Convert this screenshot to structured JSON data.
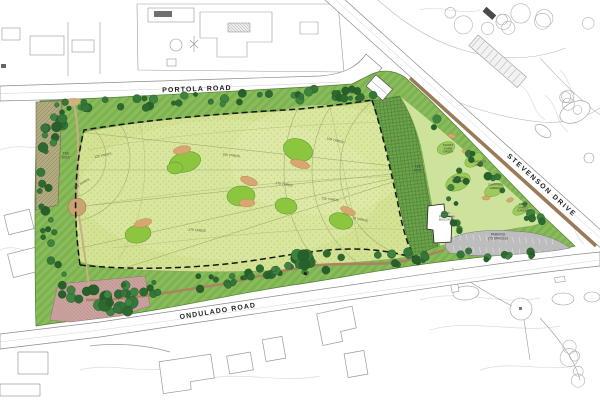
{
  "plan": {
    "roads": {
      "portola": "PORTOLA ROAD",
      "stevenson": "STEVENSON DRIVE",
      "ondulado": "ONDULADO ROAD"
    },
    "site": {
      "tee_box_west": "TEE BOX",
      "tee_box_east": "TEE BOX",
      "short_game_green": "SHORT GAME GREEN",
      "practice_tee": "PRACTICE TEE",
      "putting_green": "PUTTING GREEN",
      "chipping_green": "CHIPPING GREEN",
      "lawn_games_garden": "LAWN GAMES GARDEN",
      "building": "GOLF PROGRAM BUILDING",
      "parking_title": "PARKING",
      "parking_detail": "(75 SPACES)"
    },
    "yardage_markers": [
      {
        "text": "125 YARDS"
      },
      {
        "text": "100 YARDS"
      },
      {
        "text": "150 YARDS"
      },
      {
        "text": "175 YARDS"
      },
      {
        "text": "275 YARDS"
      },
      {
        "text": "100 YARDS"
      },
      {
        "text": "125 YARDS"
      },
      {
        "text": "75 YARDS"
      }
    ],
    "colors": {
      "field": "#d3e293",
      "perimeter_green": "#7cb34f",
      "tree_dark": "#2d6a30",
      "target_green": "#8cc63f",
      "bunker_tan": "#d7a76f",
      "tee_hatch_green": "#6ca04a",
      "path_brown": "#9b7a58",
      "parking_gray": "#bdbdbd",
      "pink_area": "#cba39f",
      "olive_area": "#b3ab80"
    }
  }
}
